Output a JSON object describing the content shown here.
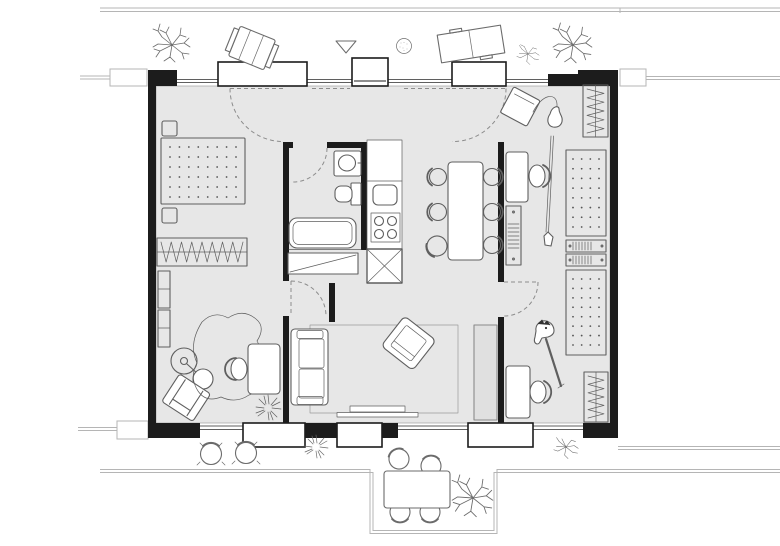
{
  "document": {
    "type": "architectural-floor-plan",
    "title": "Apartment floor plan with furniture, top-down view",
    "visible_text": "none"
  },
  "colors": {
    "floor": "#e7e7e7",
    "wall": "#1c1c1c",
    "furniture_line": "#5f5f5f",
    "glazing": "#5f5f5f",
    "site_line": "#b5b5b5",
    "dash": "#8c8c8c",
    "dot": "#555555",
    "cabinet_fill": "#e0e0e0",
    "white": "#ffffff"
  },
  "symbols": {
    "entrance_marker": "open triangle pointing down above entrance door",
    "door_swing": "dashed quarter-circle arcs",
    "window": "thin double line between wall piers",
    "bed_mattress": "dot grid",
    "wardrobe": "zigzag hanger line"
  },
  "rooms": [
    {
      "name": "bedroom-study",
      "furniture": [
        "double-bed",
        "nightstand",
        "nightstand",
        "wardrobe",
        "shelf-unit",
        "shelf-unit",
        "floor-lamp",
        "armchair",
        "animal-hide-rug",
        "desk",
        "desk-chair",
        "plant"
      ]
    },
    {
      "name": "bathroom",
      "furniture": [
        "washbasin",
        "toilet",
        "bathtub",
        "washing-machine"
      ]
    },
    {
      "name": "kitchen",
      "furniture": [
        "counter",
        "kitchen-sink",
        "cooktop-4-burners",
        "refrigerator-x-box"
      ]
    },
    {
      "name": "dining-area",
      "furniture": [
        "dining-table",
        "dining-chair x6",
        "pulled-out-chair"
      ]
    },
    {
      "name": "living-room",
      "furniture": [
        "sofa",
        "armchair",
        "rug",
        "tv-bench",
        "tall-cabinet"
      ]
    },
    {
      "name": "kids-room",
      "furniture": [
        "desk",
        "desk-chair",
        "media-shelf",
        "bed",
        "drawer-unit",
        "drawer-unit",
        "bed",
        "wardrobe",
        "wardrobe",
        "guitar",
        "amplifier",
        "hobby-horse",
        "desk",
        "desk-chair"
      ]
    },
    {
      "name": "hall",
      "furniture": []
    }
  ],
  "outdoor": {
    "top": [
      "street-line",
      "deciduous-tree",
      "lounge-chair",
      "entrance-marker-triangle",
      "round-shrub",
      "double-sun-lounger",
      "small-tree",
      "large-tree"
    ],
    "bottom": [
      "sidewalk-line",
      "bistro-chair",
      "bistro-chair",
      "spiky-plant",
      "terrace-table",
      "terrace-chair x4",
      "terrace-tree",
      "small-tree"
    ]
  },
  "counts": {
    "windows_top": 4,
    "windows_bottom": 3,
    "door_swings": 6,
    "beds": 3,
    "wardrobes": 3,
    "desks": 3,
    "trees": 6
  }
}
